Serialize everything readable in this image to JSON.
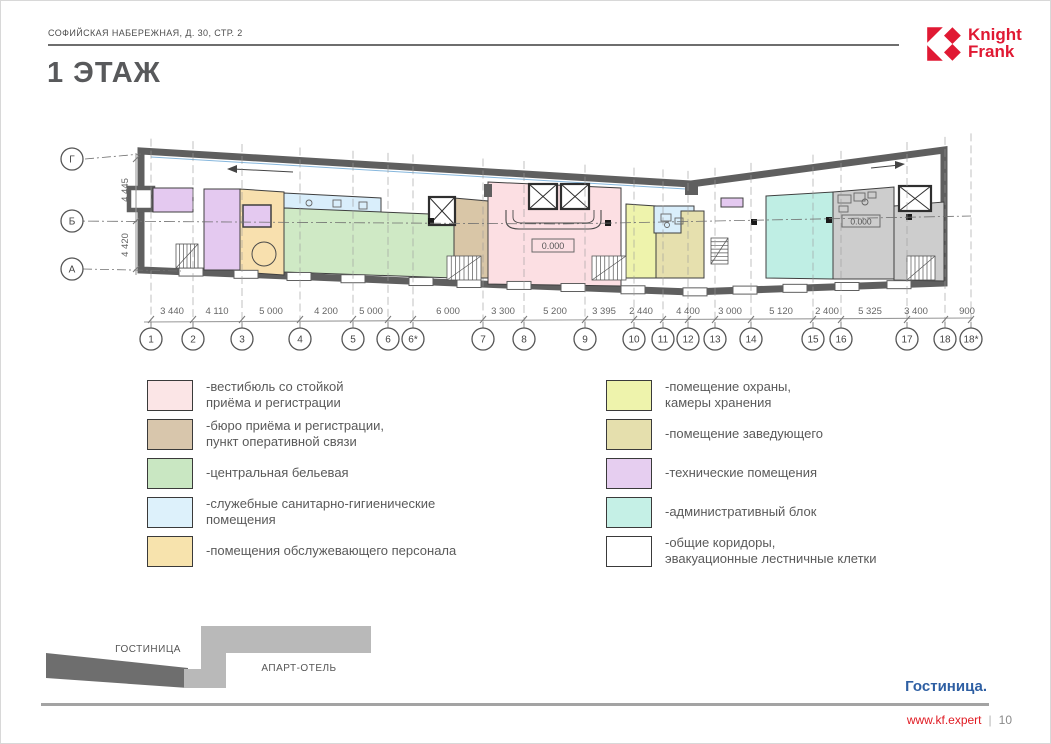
{
  "header": {
    "breadcrumb": "СОФИЙСКАЯ НАБЕРЕЖНАЯ, Д. 30, СТР. 2",
    "title": "1 ЭТАЖ"
  },
  "logo": {
    "line1": "Knight",
    "line2": "Frank",
    "brand_color": "#e01933"
  },
  "plan": {
    "level_mark": "0.000",
    "row_axes": [
      "Г",
      "Б",
      "А"
    ],
    "row_dims": [
      "4 445",
      "4 420"
    ],
    "col_axes": [
      "1",
      "2",
      "3",
      "4",
      "5",
      "6",
      "6*",
      "7",
      "8",
      "9",
      "10",
      "11",
      "12",
      "13",
      "14",
      "15",
      "16",
      "17",
      "18",
      "18*"
    ],
    "col_dims": [
      "3 440",
      "4 110",
      "5 000",
      "4 200",
      "5 000",
      "6 000",
      "3 300",
      "5 200",
      "3 395",
      "2 440",
      "4 400",
      "3 000",
      "5 120",
      "2 400",
      "5 325",
      "3 400",
      "900"
    ]
  },
  "legend": {
    "left": [
      {
        "color": "#fbe5e6",
        "lines": [
          "-вестибюль со стойкой",
          "приёма и регистрации"
        ]
      },
      {
        "color": "#d8c6ac",
        "lines": [
          "-бюро приёма и регистрации,",
          "пункт оперативной связи"
        ]
      },
      {
        "color": "#c9e7c2",
        "lines": [
          "-центральная бельевая"
        ]
      },
      {
        "color": "#ddf1fb",
        "lines": [
          "-служебные санитарно-гигиенические",
          "помещения"
        ]
      },
      {
        "color": "#f7e3ad",
        "lines": [
          "-помещения обслужевающего персонала"
        ]
      }
    ],
    "right": [
      {
        "color": "#eef3ac",
        "lines": [
          "-помещение охраны,",
          "камеры хранения"
        ]
      },
      {
        "color": "#e5dfad",
        "lines": [
          "-помещение заведующего"
        ]
      },
      {
        "color": "#e6cef0",
        "lines": [
          "-технические помещения"
        ]
      },
      {
        "color": "#c5f0e6",
        "lines": [
          "-административный блок"
        ]
      },
      {
        "color": "#ffffff",
        "lines": [
          "-общие коридоры,",
          "эвакуационные лестничные клетки"
        ]
      }
    ]
  },
  "keyplan": {
    "hotel_label": "ГОСТИНИЦА",
    "apart_label": "АПАРТ-ОТЕЛЬ"
  },
  "footer": {
    "note": "Гостиница.",
    "site": "www.kf.expert",
    "separator": "|",
    "page": "10"
  }
}
